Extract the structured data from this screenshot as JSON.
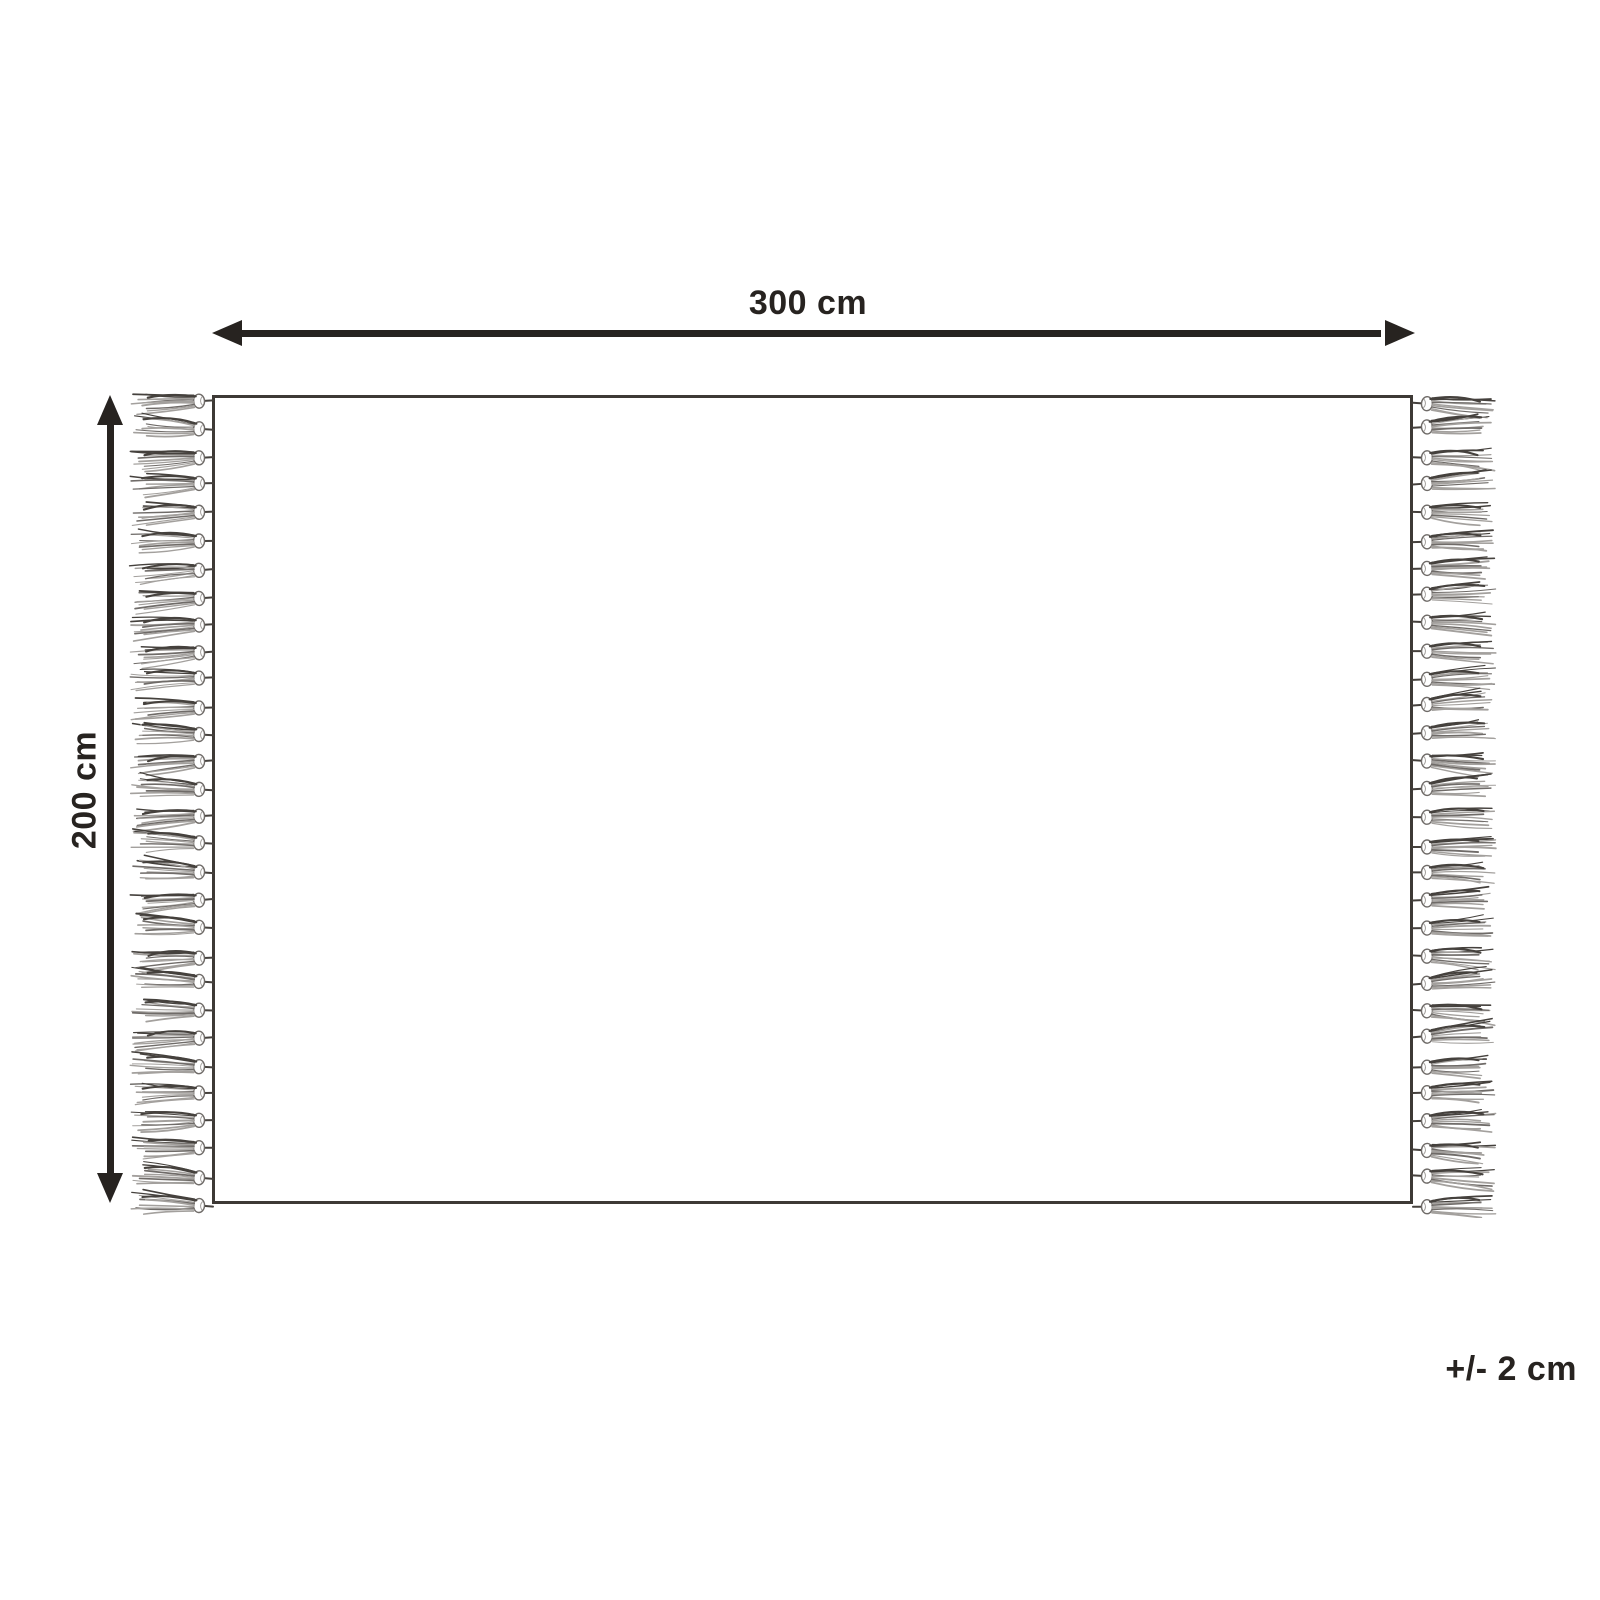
{
  "diagram": {
    "width_label": "300 cm",
    "height_label": "200 cm",
    "tolerance_label": "+/- 2 cm",
    "tassels_per_side": 30,
    "colors": {
      "background": "#ffffff",
      "line": "#272320",
      "text": "#272320",
      "rug_border": "#3d3935",
      "rug_fill": "#ffffff",
      "tassel_dark": "#45413d",
      "tassel_mid": "#6f6b68",
      "tassel_light": "#a3a09d"
    }
  }
}
